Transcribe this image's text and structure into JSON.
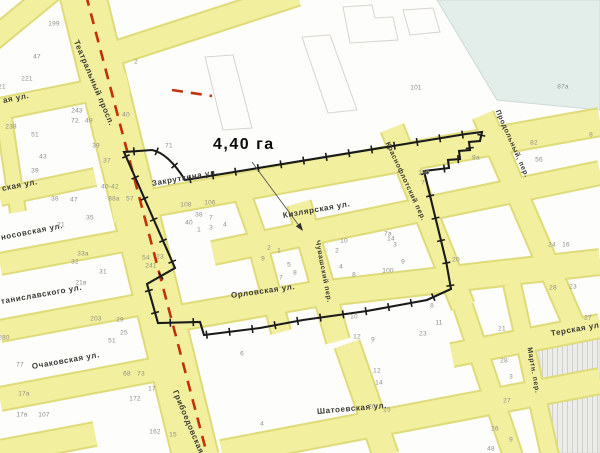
{
  "map": {
    "area_label": "4,40 га",
    "colors": {
      "street_fill": "#f2ef9e",
      "street_edge": "#dfdb79",
      "water_area": "#e3eeea",
      "hatch_area": "#ecece9",
      "boundary_line": "#1a1a1a",
      "district_dash_line": "#c23208",
      "building_outline": "#d8d4cc",
      "street_text": "#3a3a34",
      "number_text": "#8f8f88"
    },
    "street_labels": [
      {
        "text": "Театральный просп.",
        "x": 76,
        "y": 36,
        "rot": 67,
        "size": 8
      },
      {
        "text": "Грибоедовская",
        "x": 175,
        "y": 386,
        "rot": 67,
        "size": 8
      },
      {
        "text": "ая ул.",
        "x": 3,
        "y": 96,
        "rot": -11,
        "size": 8
      },
      {
        "text": "ская ул.",
        "x": 2,
        "y": 184,
        "rot": -11,
        "size": 8
      },
      {
        "text": "носовская ул.",
        "x": 1,
        "y": 233,
        "rot": -11,
        "size": 8
      },
      {
        "text": "таниславского ул.",
        "x": 1,
        "y": 297,
        "rot": -10,
        "size": 8
      },
      {
        "text": "Очаковская ул.",
        "x": 32,
        "y": 362,
        "rot": -10,
        "size": 8
      },
      {
        "text": "Закруткина ул.",
        "x": 152,
        "y": 179,
        "rot": -10,
        "size": 8
      },
      {
        "text": "Кизлярская ул.",
        "x": 283,
        "y": 211,
        "rot": -10,
        "size": 8
      },
      {
        "text": "Орловская ул.",
        "x": 231,
        "y": 291,
        "rot": -8,
        "size": 8
      },
      {
        "text": "Терская ул.",
        "x": 551,
        "y": 329,
        "rot": -10,
        "size": 8
      },
      {
        "text": "Шатоевская ул.",
        "x": 317,
        "y": 407,
        "rot": -5,
        "size": 8
      },
      {
        "text": "Чувашский пер.",
        "x": 317,
        "y": 237,
        "rot": 79,
        "size": 7
      },
      {
        "text": "Краснофлотский пер.",
        "x": 387,
        "y": 139,
        "rot": 65,
        "size": 7
      },
      {
        "text": "Продольный, пер.",
        "x": 497,
        "y": 107,
        "rot": 66,
        "size": 7
      },
      {
        "text": "Мартн. пер.",
        "x": 529,
        "y": 344,
        "rot": 80,
        "size": 7
      }
    ],
    "block_numbers": [
      {
        "text": "199",
        "x": 54,
        "y": 24
      },
      {
        "text": "47",
        "x": 37,
        "y": 57
      },
      {
        "text": "221",
        "x": 27,
        "y": 79
      },
      {
        "text": "21",
        "x": 2,
        "y": 87
      },
      {
        "text": "243",
        "x": 77,
        "y": 111
      },
      {
        "text": "72",
        "x": 75,
        "y": 121
      },
      {
        "text": "49",
        "x": 89,
        "y": 121
      },
      {
        "text": "40",
        "x": 126,
        "y": 115
      },
      {
        "text": "238",
        "x": 11,
        "y": 127
      },
      {
        "text": "51",
        "x": 35,
        "y": 135
      },
      {
        "text": "39",
        "x": 96,
        "y": 146
      },
      {
        "text": "43",
        "x": 43,
        "y": 157
      },
      {
        "text": "37",
        "x": 107,
        "y": 161
      },
      {
        "text": "39",
        "x": 35,
        "y": 171
      },
      {
        "text": "40-42",
        "x": 110,
        "y": 187
      },
      {
        "text": "88а",
        "x": 114,
        "y": 199
      },
      {
        "text": "57",
        "x": 130,
        "y": 199
      },
      {
        "text": "38",
        "x": 55,
        "y": 199
      },
      {
        "text": "47",
        "x": 74,
        "y": 200
      },
      {
        "text": "35",
        "x": 90,
        "y": 218
      },
      {
        "text": "21",
        "x": 61,
        "y": 225
      },
      {
        "text": "33а",
        "x": 83,
        "y": 254
      },
      {
        "text": "32",
        "x": 75,
        "y": 262
      },
      {
        "text": "31",
        "x": 103,
        "y": 272
      },
      {
        "text": "21в",
        "x": 81,
        "y": 283
      },
      {
        "text": "203",
        "x": 96,
        "y": 319
      },
      {
        "text": "29",
        "x": 120,
        "y": 320
      },
      {
        "text": "25",
        "x": 124,
        "y": 333
      },
      {
        "text": "51",
        "x": 112,
        "y": 341
      },
      {
        "text": "280",
        "x": 4,
        "y": 338
      },
      {
        "text": "77",
        "x": 20,
        "y": 365
      },
      {
        "text": "68",
        "x": 127,
        "y": 374
      },
      {
        "text": "73",
        "x": 141,
        "y": 374
      },
      {
        "text": "17",
        "x": 152,
        "y": 389
      },
      {
        "text": "172",
        "x": 135,
        "y": 399
      },
      {
        "text": "17а",
        "x": 24,
        "y": 394
      },
      {
        "text": "107",
        "x": 44,
        "y": 415
      },
      {
        "text": "17в",
        "x": 22,
        "y": 415
      },
      {
        "text": "162",
        "x": 155,
        "y": 432
      },
      {
        "text": "15",
        "x": 173,
        "y": 435
      },
      {
        "text": "2",
        "x": 136,
        "y": 62
      },
      {
        "text": "71",
        "x": 169,
        "y": 146
      },
      {
        "text": "101",
        "x": 416,
        "y": 88
      },
      {
        "text": "87а",
        "x": 563,
        "y": 87
      },
      {
        "text": "108",
        "x": 186,
        "y": 205
      },
      {
        "text": "106",
        "x": 210,
        "y": 203
      },
      {
        "text": "38",
        "x": 199,
        "y": 215
      },
      {
        "text": "7",
        "x": 211,
        "y": 218
      },
      {
        "text": "40",
        "x": 189,
        "y": 223
      },
      {
        "text": "1",
        "x": 199,
        "y": 230
      },
      {
        "text": "3",
        "x": 211,
        "y": 228
      },
      {
        "text": "4",
        "x": 225,
        "y": 225
      },
      {
        "text": "2",
        "x": 269,
        "y": 248
      },
      {
        "text": "9",
        "x": 263,
        "y": 259
      },
      {
        "text": "1",
        "x": 279,
        "y": 251
      },
      {
        "text": "5",
        "x": 289,
        "y": 265
      },
      {
        "text": "7",
        "x": 281,
        "y": 278
      },
      {
        "text": "8",
        "x": 295,
        "y": 273
      },
      {
        "text": "10",
        "x": 344,
        "y": 241
      },
      {
        "text": "14",
        "x": 391,
        "y": 239
      },
      {
        "text": "2",
        "x": 337,
        "y": 251
      },
      {
        "text": "3",
        "x": 395,
        "y": 245
      },
      {
        "text": "4",
        "x": 341,
        "y": 267
      },
      {
        "text": "8",
        "x": 354,
        "y": 275
      },
      {
        "text": "100",
        "x": 388,
        "y": 271
      },
      {
        "text": "54",
        "x": 146,
        "y": 258
      },
      {
        "text": "23",
        "x": 160,
        "y": 257
      },
      {
        "text": "241",
        "x": 151,
        "y": 266
      },
      {
        "text": "180",
        "x": 424,
        "y": 173
      },
      {
        "text": "7",
        "x": 423,
        "y": 183
      },
      {
        "text": "7а",
        "x": 388,
        "y": 234
      },
      {
        "text": "9",
        "x": 403,
        "y": 262
      },
      {
        "text": "20",
        "x": 456,
        "y": 260
      },
      {
        "text": "9а",
        "x": 476,
        "y": 158
      },
      {
        "text": "82",
        "x": 534,
        "y": 143
      },
      {
        "text": "56",
        "x": 539,
        "y": 160
      },
      {
        "text": "8",
        "x": 591,
        "y": 135
      },
      {
        "text": "24",
        "x": 552,
        "y": 245
      },
      {
        "text": "16",
        "x": 566,
        "y": 245
      },
      {
        "text": "28",
        "x": 553,
        "y": 288
      },
      {
        "text": "23",
        "x": 573,
        "y": 287
      },
      {
        "text": "27",
        "x": 588,
        "y": 318
      },
      {
        "text": "21",
        "x": 502,
        "y": 329
      },
      {
        "text": "10",
        "x": 354,
        "y": 317
      },
      {
        "text": "8",
        "x": 432,
        "y": 306
      },
      {
        "text": "11",
        "x": 439,
        "y": 323
      },
      {
        "text": "12",
        "x": 357,
        "y": 337
      },
      {
        "text": "9",
        "x": 373,
        "y": 340
      },
      {
        "text": "23",
        "x": 423,
        "y": 334
      },
      {
        "text": "6",
        "x": 242,
        "y": 354
      },
      {
        "text": "12",
        "x": 377,
        "y": 371
      },
      {
        "text": "14",
        "x": 379,
        "y": 383
      },
      {
        "text": "20",
        "x": 372,
        "y": 407
      },
      {
        "text": "15",
        "x": 387,
        "y": 410
      },
      {
        "text": "4",
        "x": 262,
        "y": 424
      },
      {
        "text": "28",
        "x": 504,
        "y": 361
      },
      {
        "text": "3",
        "x": 511,
        "y": 377
      },
      {
        "text": "27",
        "x": 507,
        "y": 401
      },
      {
        "text": "26",
        "x": 495,
        "y": 429
      },
      {
        "text": "9",
        "x": 511,
        "y": 440
      },
      {
        "text": "48",
        "x": 491,
        "y": 449
      }
    ]
  }
}
